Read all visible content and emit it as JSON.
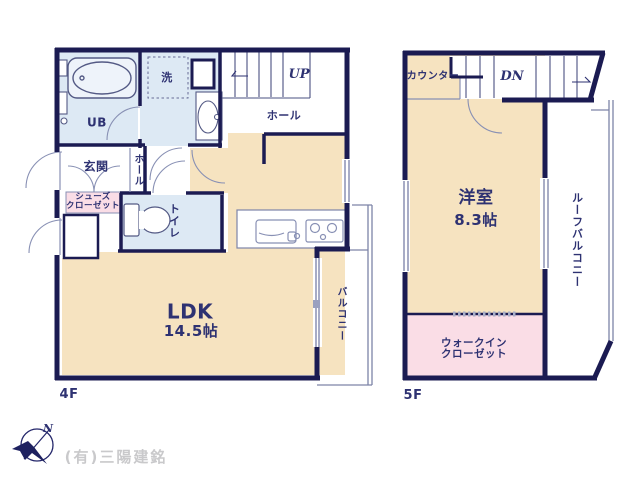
{
  "document": {
    "type": "floor-plan",
    "background": "#ffffff"
  },
  "colors": {
    "wall_navy": "#1b1b52",
    "floor_cream": "#f6e3c0",
    "wet_area_blue": "#dde9f4",
    "closet_pink": "#fadde6",
    "label_text": "#2e3272",
    "rail_gray": "#7d84a8",
    "company_gray": "#c9c9cb"
  },
  "plan4f": {
    "floor_label": "4F",
    "stairs": "UP",
    "rooms": {
      "ldk": {
        "name": "LDK",
        "area": "14.5帖"
      },
      "unit_bath": "UB",
      "laundry": "洗",
      "hall_upper": "ホール",
      "entrance": "玄関",
      "hall_entry": "ホール",
      "shoe_closet": {
        "line1": "シューズ",
        "line2": "クローゼット"
      },
      "toilet": "トイレ",
      "balcony": "バルコニー"
    }
  },
  "plan5f": {
    "floor_label": "5F",
    "stairs": "DN",
    "rooms": {
      "western_room": {
        "name": "洋室",
        "area": "8.3帖"
      },
      "counter": "カウンター",
      "walk_in_closet": {
        "line1": "ウォークイン",
        "line2": "クローゼット"
      },
      "roof_balcony": "ルーフバルコニー"
    }
  },
  "footer": {
    "company": "(有)三陽建銘",
    "compass_north": "N"
  }
}
